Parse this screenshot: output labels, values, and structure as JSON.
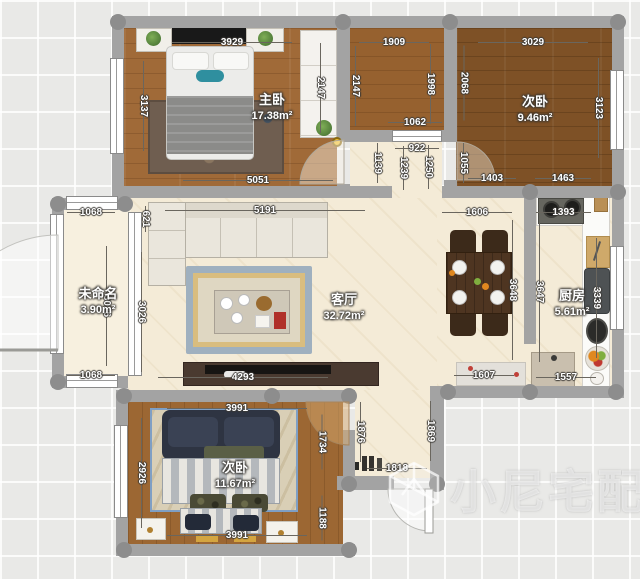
{
  "app": {
    "watermark": "小尼宅配"
  },
  "colors": {
    "wall": "#a3a3a3",
    "floor_wood": "#a06a38",
    "floor_wood_dark": "#7e5126",
    "floor_cream": "#f4ebd7",
    "accent_device": "#f2c12e",
    "rug_border_blue": "#9fb0bf",
    "dim_text": "#ffffff",
    "label_text": "#ffffff"
  },
  "rooms": {
    "master": {
      "name": "主卧",
      "area": "17.38m²",
      "dims": {
        "top": "3929",
        "left": "3137",
        "right": "2147",
        "bottom": "5051"
      }
    },
    "bath": {
      "dims": {
        "top": "1909",
        "left": "2147",
        "right": "1998",
        "door": "1062"
      }
    },
    "bedroom2": {
      "name": "次卧",
      "area": "9.46m²",
      "dims": {
        "top": "3029",
        "left": "2068",
        "right": "3123",
        "bottom_left": "1403",
        "bottom_right": "1463"
      }
    },
    "corridor": {
      "dims": {
        "width": "922",
        "left": "1139",
        "mid_left": "1239",
        "mid_right": "1250",
        "right": "1055"
      }
    },
    "balcony": {
      "name": "未命名",
      "area": "3.90m²",
      "dims": {
        "top": "1068",
        "left": "3026",
        "right": "3026",
        "bottom": "1068",
        "niche": "621"
      }
    },
    "living": {
      "name": "客厅",
      "area": "32.72m²",
      "dims": {
        "top": "5191",
        "bottom": "4293"
      }
    },
    "dining": {
      "dims": {
        "top": "1606",
        "right": "3648",
        "bottom": "1607"
      }
    },
    "kitchen": {
      "name": "厨房",
      "area": "5.61m²",
      "dims": {
        "top": "1393",
        "left": "3647",
        "right": "3339",
        "bottom": "1557"
      }
    },
    "bedroom3": {
      "name": "次卧",
      "area": "11.67m²",
      "dims": {
        "top": "3991",
        "left": "2926",
        "bottom": "3991",
        "door": "1734",
        "right": "1188"
      }
    },
    "hallway": {
      "dims": {
        "left": "1876",
        "right": "1869",
        "bottom": "1818"
      }
    }
  }
}
